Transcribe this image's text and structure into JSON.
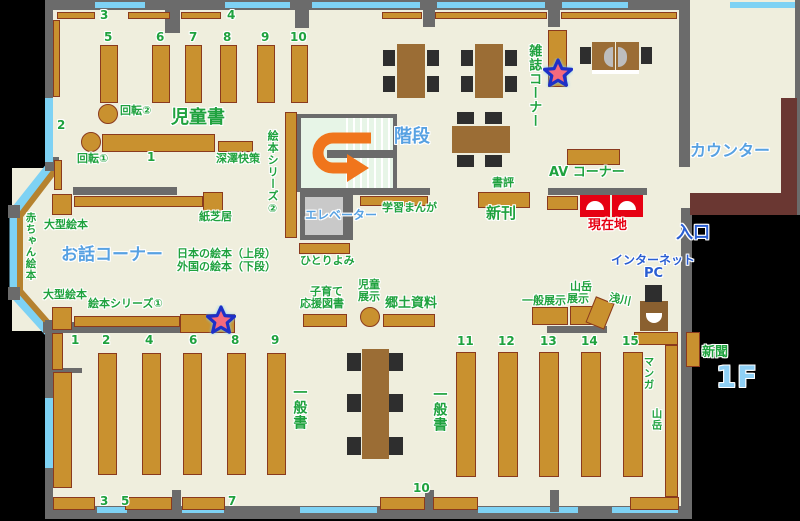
{
  "colors": {
    "floor": "#efeedd",
    "outside": "#000000",
    "wall": "#6b6b6b",
    "window": "#7ed2f4",
    "shelf": "#c9912f",
    "shelf_border": "#8a3a1e",
    "green_label": "#1fa23e",
    "light_blue_label": "#57a1e2",
    "deep_blue_label": "#2a5ed2",
    "red_label": "#e60012",
    "counter_brown": "#6a3732",
    "table_brown": "#9b6d35",
    "chair": "#2e2e2e",
    "arrow_orange": "#f0751c",
    "stairs_bg": "#e7f5e7",
    "elevator_gray": "#c9c9c9",
    "floor_badge_blue": "#8fd0f5",
    "star_fill": "#f56a7d",
    "star_outline": "#1e30c8"
  },
  "floor_badge": "1F",
  "labels": {
    "kids_books": "児童書",
    "story_corner": "お話コーナー",
    "magazine_corner": "雑誌コーナー",
    "av_corner": "AV コーナー",
    "counter": "カウンター",
    "entrance": "入口",
    "internet_line1": "インターネット",
    "internet_line2": "PC",
    "current_location": "現在地",
    "stairs": "階段",
    "elevator": "エレベーター",
    "newspaper": "新聞",
    "new_arrivals": "新刊",
    "book_review": "書評",
    "rotating_rack_1": "回転①",
    "rotating_rack_2": "回転②",
    "fukazawa": "深澤快策",
    "picture_book_series_1": "絵本シリーズ①",
    "picture_book_series_2": "絵本シリーズ②",
    "kamishibai": "紙芝居",
    "large_picture_books_a": "大型絵本",
    "large_picture_books_b": "大型絵本",
    "baby_picture_books": "赤ちゃん絵本",
    "japanese_picture_books": "日本の絵本（上段）",
    "foreign_picture_books": "外国の絵本（下段）",
    "solo_reading": "ひとりよみ",
    "study_manga": "学習まんが",
    "childcare_line1": "子育て",
    "childcare_line2": "応援図書",
    "child_display_line1": "児童",
    "child_display_line2": "展示",
    "local_materials": "郷土資料",
    "general_display": "一般展示",
    "mountain_display_line1": "山岳",
    "mountain_display_line2": "展示",
    "asakawa": "浅川",
    "general_books_a": "一般書",
    "general_books_b": "一般書",
    "manga": "マンガ",
    "mountain": "山岳"
  },
  "numbers": {
    "t3": "3",
    "t4": "4",
    "k5": "5",
    "k6": "6",
    "k7": "7",
    "k8": "8",
    "k9": "9",
    "k10": "10",
    "w2": "2",
    "s1": "1",
    "b1": "1",
    "b2": "2",
    "b4": "4",
    "b6": "6",
    "b8": "8",
    "b9": "9",
    "e3": "3",
    "e5": "5",
    "e7": "7",
    "e10": "10",
    "r11": "11",
    "r12": "12",
    "r13": "13",
    "r14": "14",
    "r15": "15"
  }
}
